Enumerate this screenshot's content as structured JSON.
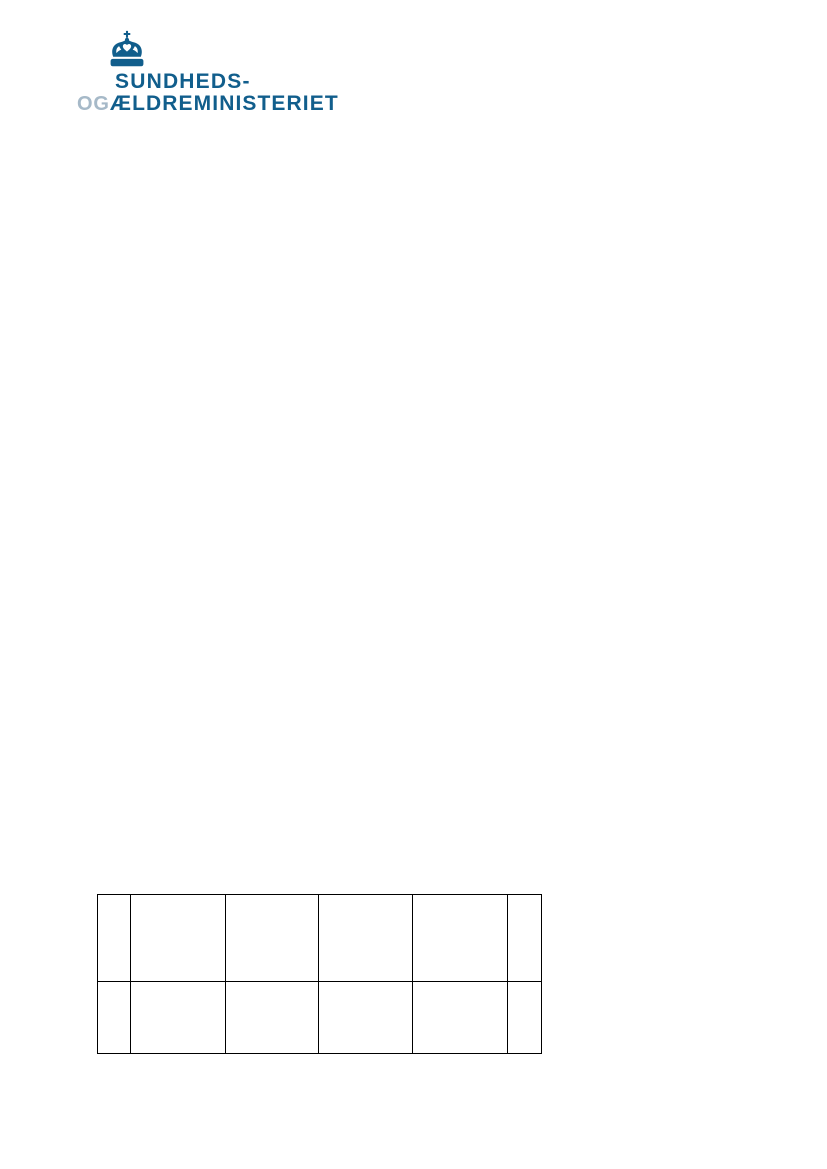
{
  "page": {
    "background_color": "#ffffff"
  },
  "logo": {
    "crown_icon": "danish-royal-crown",
    "line1": "SUNDHEDS-",
    "line2_prefix": "OG",
    "line2_main": "ÆLDREMINISTERIET",
    "brand_color": "#115E8C",
    "prefix_color": "#A6B9C8"
  },
  "table": {
    "columns": 6,
    "row_count": 2,
    "border_color": "#000000",
    "rows": [
      [
        "",
        "",
        "",
        "",
        "",
        ""
      ],
      [
        "",
        "",
        "",
        "",
        "",
        ""
      ]
    ]
  }
}
